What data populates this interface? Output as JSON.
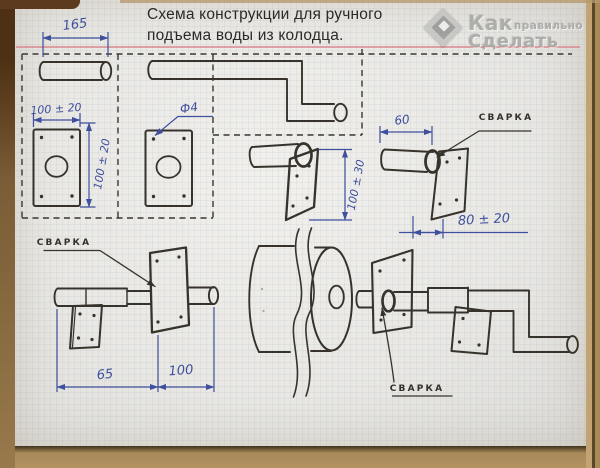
{
  "title": {
    "line1": "Схема конструкции для ручного",
    "line2": "подъема воды из колодца."
  },
  "watermark": {
    "brand_top": "Как",
    "brand_mid": "правильно",
    "brand_bottom": "Сделать"
  },
  "dimensions": {
    "handle_pipe_length": "165",
    "plate_width": "100 ± 20",
    "plate_height": "100 ± 20",
    "hole_diameter": "Ф4",
    "bracket_plate_height": "100 ± 30",
    "stub_pipe_length": "60",
    "bracket_offset": "80 ± 20",
    "axle_left_length": "65",
    "axle_right_length": "100"
  },
  "weld_labels": {
    "top_right": "СВАРКА",
    "bottom_left": "СВАРКА",
    "bottom_right": "СВАРКА"
  },
  "colors": {
    "blue_ink": "#3e4f9d",
    "black_ink": "#37332c",
    "pink_line": "#d9868c",
    "paper": "#e9e8e4",
    "wood": "#b2925f"
  }
}
